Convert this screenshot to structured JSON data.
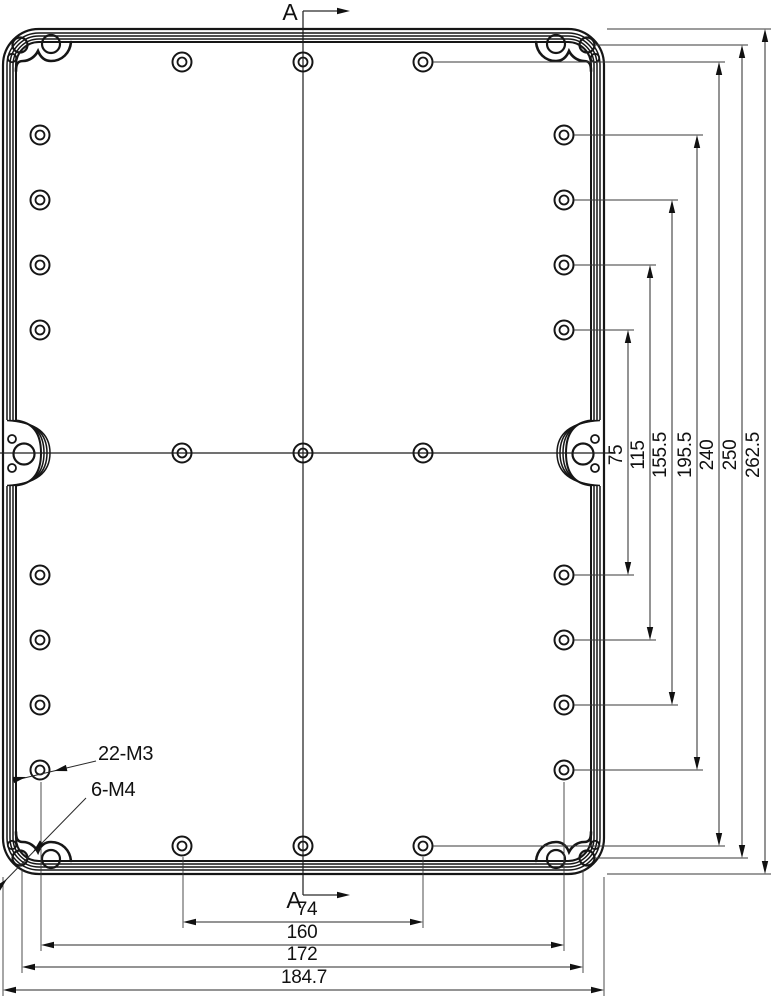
{
  "page": {
    "background": "#ffffff",
    "line_color": "#1a1a1a"
  },
  "drawing": {
    "section": {
      "top_label": "A",
      "bottom_label": "A"
    },
    "labels": {
      "m3": "22-M3",
      "m4": "6-M4"
    },
    "dims_vertical": [
      {
        "value": "75"
      },
      {
        "value": "115"
      },
      {
        "value": "155.5"
      },
      {
        "value": "195.5"
      },
      {
        "value": "240"
      },
      {
        "value": "250"
      },
      {
        "value": "262.5"
      }
    ],
    "dims_horizontal": [
      {
        "value": "74"
      },
      {
        "value": "160"
      },
      {
        "value": "172"
      },
      {
        "value": "184.7"
      }
    ]
  }
}
